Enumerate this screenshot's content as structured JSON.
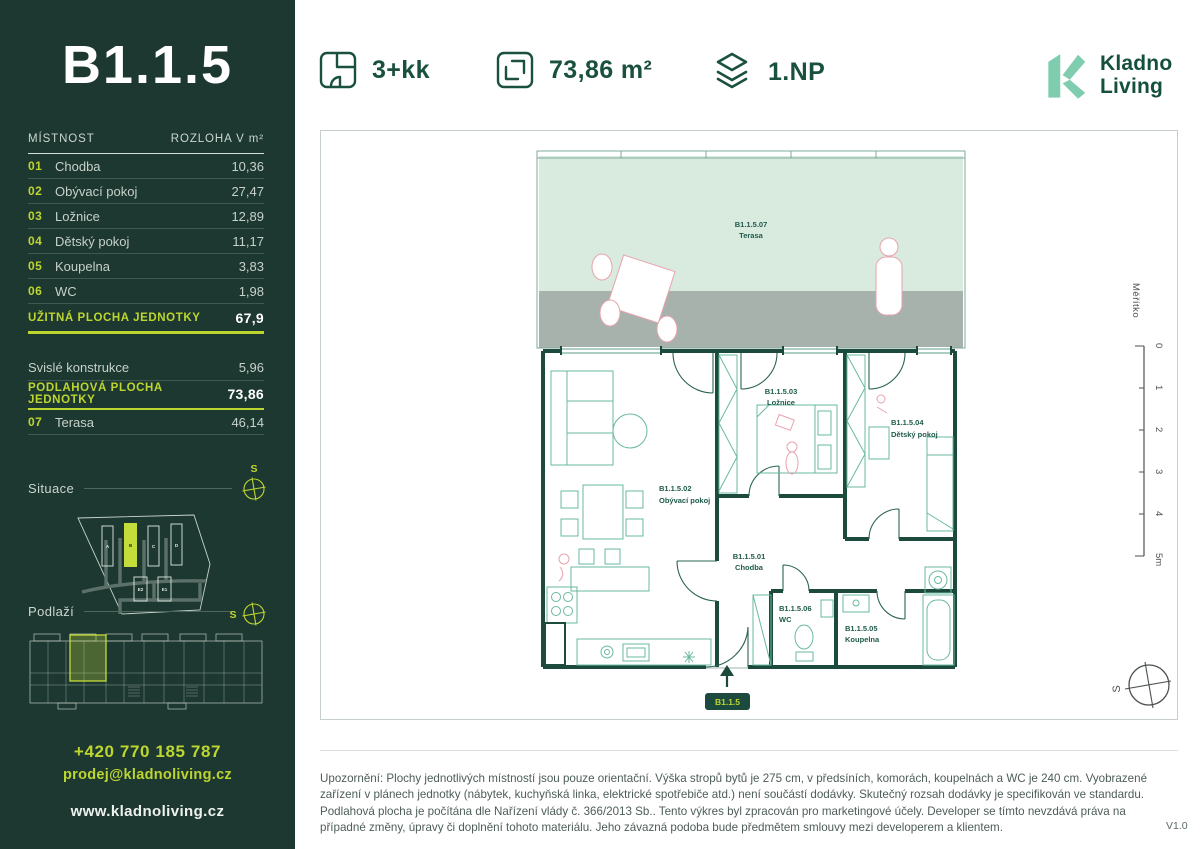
{
  "sidebar": {
    "unit_title": "B1.1.5",
    "table": {
      "header": {
        "room": "MÍSTNOST",
        "area": "ROZLOHA V m²"
      },
      "rows": [
        {
          "num": "01",
          "name": "Chodba",
          "area": "10,36"
        },
        {
          "num": "02",
          "name": "Obývací pokoj",
          "area": "27,47"
        },
        {
          "num": "03",
          "name": "Ložnice",
          "area": "12,89"
        },
        {
          "num": "04",
          "name": "Dětský pokoj",
          "area": "11,17"
        },
        {
          "num": "05",
          "name": "Koupelna",
          "area": "3,83"
        },
        {
          "num": "06",
          "name": "WC",
          "area": "1,98"
        }
      ],
      "usable": {
        "label": "UŽITNÁ PLOCHA JEDNOTKY",
        "value": "67,9"
      },
      "construction": {
        "label": "Svislé konstrukce",
        "value": "5,96"
      },
      "floor_area": {
        "label": "PODLAHOVÁ PLOCHA JEDNOTKY",
        "value": "73,86"
      },
      "terrace": {
        "num": "07",
        "name": "Terasa",
        "area": "46,14"
      }
    },
    "situace_label": "Situace",
    "podlazi_label": "Podlaží",
    "compass_letter": "S",
    "site_buildings": [
      "A",
      "B",
      "C",
      "D",
      "E2",
      "E1"
    ],
    "phone": "+420 770 185 787",
    "email": "prodej@kladnoliving.cz",
    "website": "www.kladnoliving.cz"
  },
  "header": {
    "layout": "3+kk",
    "area": "73,86 m²",
    "floor": "1.NP",
    "logo_line1": "Kladno",
    "logo_line2": "Living"
  },
  "plan": {
    "rooms": [
      {
        "code": "B1.1.5.01",
        "name": "Chodba"
      },
      {
        "code": "B1.1.5.02",
        "name": "Obývací pokoj"
      },
      {
        "code": "B1.1.5.03",
        "name": "Ložnice"
      },
      {
        "code": "B1.1.5.04",
        "name": "Dětský pokoj"
      },
      {
        "code": "B1.1.5.05",
        "name": "Koupelna"
      },
      {
        "code": "B1.1.5.06",
        "name": "WC"
      },
      {
        "code": "B1.1.5.07",
        "name": "Terasa"
      }
    ],
    "entry_badge": "B1.1.5",
    "scale": {
      "label": "Měřítko",
      "ticks": [
        "0",
        "1",
        "2",
        "3",
        "4",
        "5m"
      ]
    },
    "compass_letter": "S"
  },
  "footer": {
    "disclaimer": "Upozornění: Plochy jednotlivých místností jsou pouze orientační. Výška stropů bytů je 275 cm, v předsíních, komorách, koupelnách a WC je 240 cm. Vyobrazené zařízení v plánech jednotky (nábytek, kuchyňská linka, elektrické spotřebiče atd.) není součástí dodávky. Skutečný rozsah dodávky je specifikován ve standardu. Podlahová plocha je počítána dle Nařízení vlády č. 366/2013 Sb.. Tento výkres byl zpracován pro marketingové účely. Developer se tímto nevzdává práva na případné změny, úpravy či doplnění tohoto materiálu. Jeho závazná podoba bude předmětem smlouvy mezi developerem a klientem.",
    "version": "V1.0"
  },
  "colors": {
    "sidebar_bg": "#1d3830",
    "accent_lime": "#bdd62f",
    "dark_green": "#1a503e",
    "wall": "#1c4a3d",
    "terrace_mint": "#d9eadf",
    "terrace_gray": "#a8b2ac"
  }
}
